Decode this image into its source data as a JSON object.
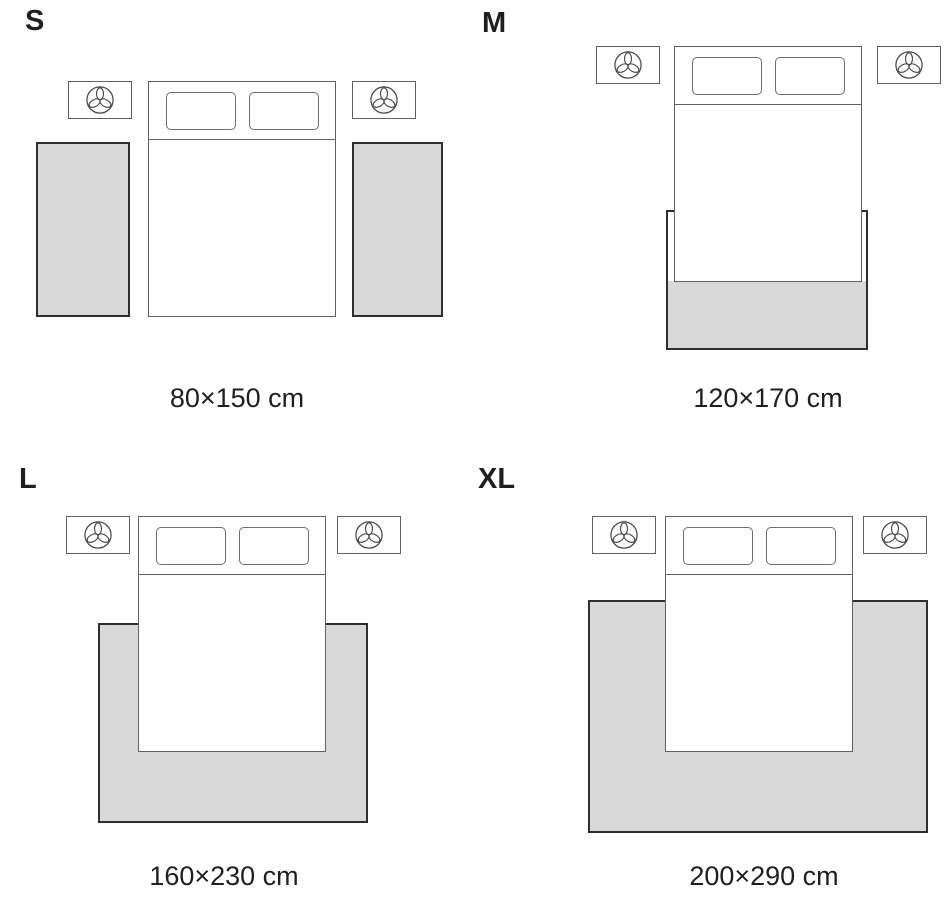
{
  "colors": {
    "background": "#ffffff",
    "rug_fill": "#d9d9d9",
    "rug_border": "#2f2f2f",
    "furniture_line": "#616161",
    "pillow_line": "#6e6e6e",
    "text": "#1f1f1f"
  },
  "icons": {
    "nightstand": "plant-icon"
  },
  "panels": [
    {
      "id": "s",
      "label": "S",
      "caption": "80×150 cm"
    },
    {
      "id": "m",
      "label": "M",
      "caption": "120×170 cm"
    },
    {
      "id": "l",
      "label": "L",
      "caption": "160×230 cm"
    },
    {
      "id": "xl",
      "label": "XL",
      "caption": "200×290 cm"
    }
  ]
}
